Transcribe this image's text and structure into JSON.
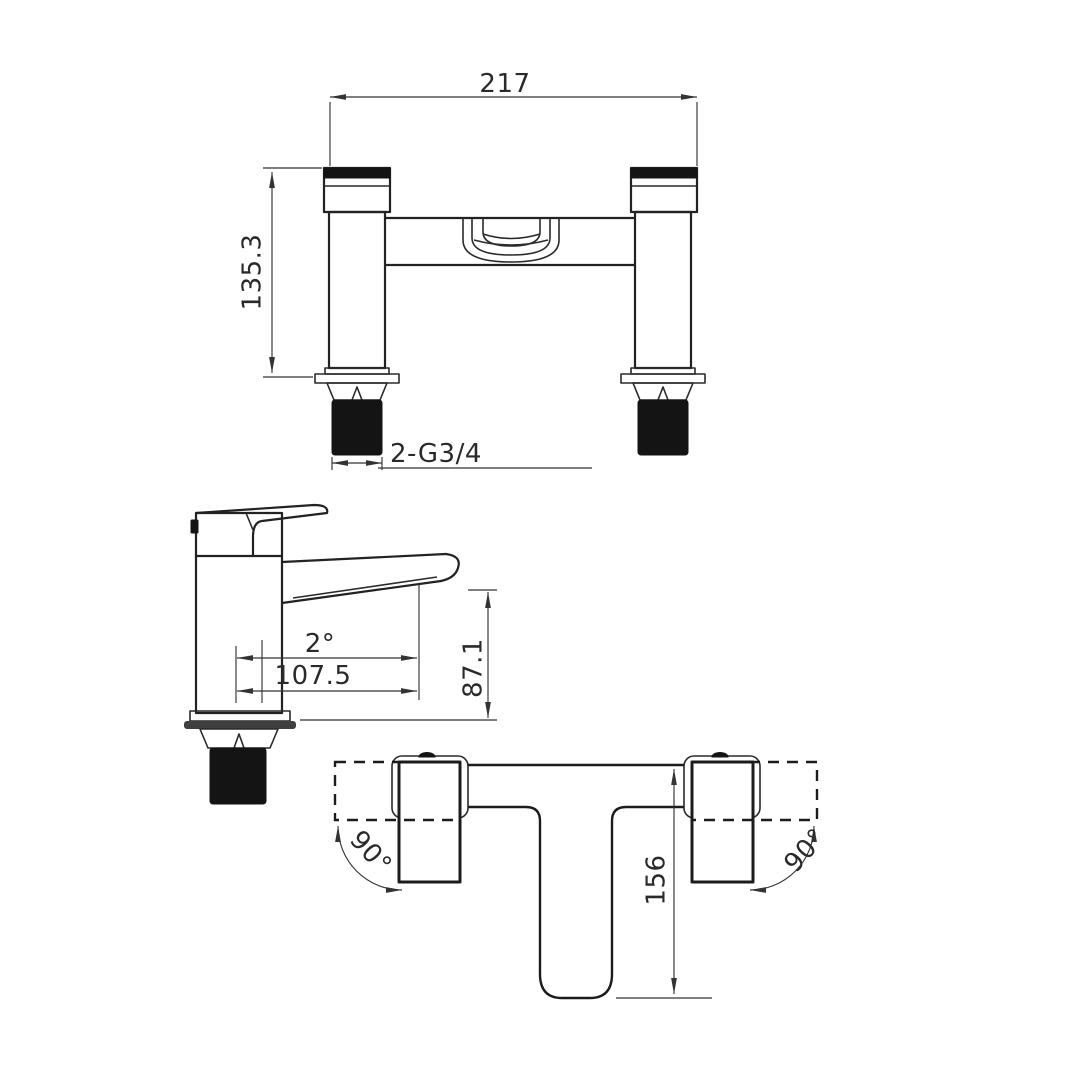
{
  "drawing_type": "tap-technical-drawing",
  "colors": {
    "background": "#ffffff",
    "line": "#222222",
    "solid_fill": "#141414",
    "gasket": "#3f3f3f"
  },
  "views": {
    "front": {
      "dims": {
        "width": "217",
        "height": "135.3",
        "thread": "2-G3/4"
      }
    },
    "side": {
      "dims": {
        "spout_angle": "2°",
        "spout_reach": "107.5",
        "spout_height": "87.1"
      }
    },
    "plan": {
      "dims": {
        "center_depth": "156",
        "left_handle_swing": "90°",
        "right_handle_swing": "90°"
      }
    }
  }
}
